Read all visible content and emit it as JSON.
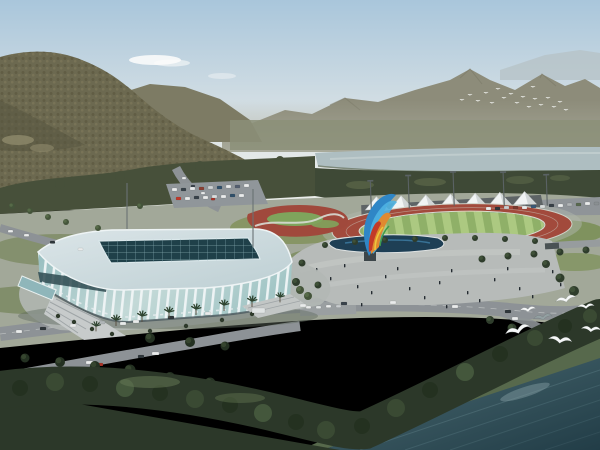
{
  "palette": {
    "skyTop": "#a9c6db",
    "skyHorizon": "#e9ebe8",
    "farRidge": "#b6c1c6",
    "farMountain": "#8d8c7a",
    "midRidge": "#7d7b64",
    "mountain": "#6c6950",
    "mountainShadow": "#585540",
    "forestBand": "#47503a",
    "forestBand2": "#3e4936",
    "river": "#aebec1",
    "parkGround": "#a2a899",
    "road": "#8d9296",
    "plaza": "#b7bbb9",
    "parking": "#90969a",
    "trackRed": "#a24a3c",
    "field1": "#8fb068",
    "field2": "#acc981",
    "tentWhite": "#f1f4f4",
    "grandstand": "#5e6466",
    "poolBlue": "#1e3f55",
    "waterTop": "#4a6a72",
    "waterDeep": "#223d47",
    "shoreGrass": "#57694c",
    "treeDark": "#2c3829",
    "treeMid": "#44543a",
    "arenaRoof": "#cfdce0",
    "arenaSkylight": "#1f4049",
    "arenaGlass": "#9dc2c2",
    "arenaRib": "#f0f5f6",
    "gull": "#f5f7f7"
  },
  "scene": {
    "title": "Aerial rendering of riverside sports complex",
    "landmarks": [
      "forested mountain",
      "distant ridge",
      "river",
      "lattice-facade indoor arena",
      "outdoor athletics track",
      "canopy grandstand",
      "ribbon sculpture",
      "plaza with reflecting pool",
      "lakeshore forest",
      "seagulls"
    ],
    "tents": {
      "x0": 366,
      "step": 24.7,
      "count": 7,
      "baseY": 207,
      "w": 23,
      "h": 13
    },
    "stand_band": {
      "x0": 372,
      "y": 209.5,
      "segW": 19.5,
      "segH": 8,
      "colors": [
        "#a64a42",
        "#4f9a52",
        "#3f64b0",
        "#7b4fa0",
        "#cf8a3c",
        "#c9bf4a",
        "#4286b2",
        "#52974e"
      ]
    },
    "track_poles": [
      [
        372,
        178,
        32
      ],
      [
        410,
        174,
        33
      ],
      [
        455,
        172,
        34
      ],
      [
        505,
        174,
        34
      ],
      [
        548,
        178,
        31
      ]
    ],
    "masts": [
      [
        127,
        183,
        46
      ],
      [
        253,
        189,
        58
      ]
    ],
    "cars": [
      [
        16,
        330,
        "#e9ebeb"
      ],
      [
        40,
        327,
        "#2f373b"
      ],
      [
        70,
        324,
        "#e9ebeb"
      ],
      [
        99,
        321,
        "#b0b6b8"
      ],
      [
        120,
        322,
        "#e9ebeb"
      ],
      [
        133,
        320,
        "#e9ebeb"
      ],
      [
        168,
        316,
        "#2f373b"
      ],
      [
        205,
        312,
        "#e9ebeb"
      ],
      [
        252,
        308,
        "#dfe3e3",
        13,
        5
      ],
      [
        300,
        304,
        "#e9ebeb"
      ],
      [
        341,
        302,
        "#3a434b"
      ],
      [
        390,
        301,
        "#e9ebeb"
      ],
      [
        452,
        305,
        "#e9ebeb"
      ],
      [
        505,
        310,
        "#2f373b"
      ],
      [
        8,
        375,
        "#e9ebeb"
      ],
      [
        28,
        371,
        "#e9ebeb"
      ],
      [
        50,
        367,
        "#c23a2c"
      ],
      [
        86,
        361,
        "#e9ebeb",
        7,
        3
      ],
      [
        97,
        363,
        "#a83428"
      ],
      [
        138,
        355,
        "#2f373b"
      ],
      [
        152,
        352,
        "#e9ebeb",
        7,
        3
      ],
      [
        8,
        230,
        "#e9ebeb",
        5,
        2.5
      ],
      [
        24,
        234,
        "#e9ebeb",
        5,
        2.5
      ],
      [
        50,
        241,
        "#2f373b",
        5,
        2.5
      ],
      [
        78,
        248,
        "#e9ebeb",
        5,
        2.5
      ],
      [
        182,
        177,
        "#e9ebeb",
        4,
        2.2
      ],
      [
        191,
        185,
        "#3a434b",
        4,
        2.2
      ],
      [
        201,
        192,
        "#e9ebeb",
        4,
        2.2
      ],
      [
        211,
        198,
        "#a83428",
        4,
        2.2
      ],
      [
        172,
        188,
        "#e9ebeb",
        5,
        3
      ],
      [
        181,
        188,
        "#39424a",
        5,
        3
      ],
      [
        190,
        187,
        "#e9ebeb",
        5,
        3
      ],
      [
        199,
        187,
        "#8a4034",
        5,
        3
      ],
      [
        208,
        186,
        "#cfd3d4",
        5,
        3
      ],
      [
        217,
        186,
        "#30506a",
        5,
        3
      ],
      [
        226,
        185,
        "#e9ebeb",
        5,
        3
      ],
      [
        235,
        185,
        "#556070",
        5,
        3
      ],
      [
        244,
        184,
        "#e9ebeb",
        5,
        3
      ],
      [
        176,
        197,
        "#c03a2c",
        5,
        3
      ],
      [
        185,
        197,
        "#e9ebeb",
        5,
        3
      ],
      [
        194,
        196,
        "#39424a",
        5,
        3
      ],
      [
        203,
        196,
        "#e9ebeb",
        5,
        3
      ],
      [
        212,
        195,
        "#d8dcdc",
        5,
        3
      ],
      [
        221,
        195,
        "#e9ebeb",
        5,
        3
      ],
      [
        230,
        194,
        "#30506a",
        5,
        3
      ],
      [
        239,
        194,
        "#e9ebeb",
        5,
        3
      ],
      [
        486,
        207,
        "#e9ebeb",
        5,
        3
      ],
      [
        495,
        207,
        "#2f373b",
        5,
        3
      ],
      [
        504,
        206,
        "#c8ccce",
        5,
        3
      ],
      [
        513,
        206,
        "#7a3a30",
        5,
        3
      ],
      [
        522,
        206,
        "#e9ebeb",
        5,
        3
      ],
      [
        531,
        205,
        "#3a5a78",
        5,
        3
      ],
      [
        540,
        205,
        "#d8dcdc",
        5,
        3
      ],
      [
        549,
        204,
        "#384048",
        5,
        3
      ],
      [
        558,
        204,
        "#e9ebeb",
        5,
        3
      ],
      [
        567,
        203,
        "#b0b4b6",
        5,
        3
      ],
      [
        576,
        203,
        "#5a6a50",
        5,
        3
      ],
      [
        585,
        202,
        "#e9ebeb",
        5,
        3
      ],
      [
        594,
        202,
        "#8a8f92",
        5,
        3
      ],
      [
        306,
        306,
        "#e9ebeb",
        5,
        2.6
      ],
      [
        316,
        306,
        "#dfe3e3",
        5,
        2.6
      ],
      [
        326,
        305,
        "#e9ebeb",
        5,
        2.6
      ],
      [
        336,
        305,
        "#c8ccce",
        5,
        2.6
      ],
      [
        512,
        317,
        "#e9ebeb"
      ],
      [
        538,
        329,
        "#2f373b"
      ]
    ],
    "people": [
      [
        316,
        268
      ],
      [
        330,
        277
      ],
      [
        344,
        264
      ],
      [
        357,
        285
      ],
      [
        371,
        291
      ],
      [
        385,
        275
      ],
      [
        397,
        267
      ],
      [
        409,
        287
      ],
      [
        424,
        296
      ],
      [
        439,
        281
      ],
      [
        451,
        269
      ],
      [
        467,
        291
      ],
      [
        479,
        299
      ],
      [
        494,
        278
      ],
      [
        507,
        267
      ],
      [
        519,
        287
      ],
      [
        532,
        295
      ],
      [
        309,
        294
      ],
      [
        361,
        303
      ],
      [
        446,
        305
      ],
      [
        262,
        306
      ],
      [
        275,
        310
      ],
      [
        287,
        302
      ],
      [
        552,
        270
      ],
      [
        560,
        283
      ]
    ],
    "palms": [
      [
        116,
        320,
        1
      ],
      [
        142,
        316,
        1
      ],
      [
        169,
        312,
        1
      ],
      [
        196,
        309,
        1
      ],
      [
        224,
        305,
        1
      ],
      [
        252,
        301,
        1
      ],
      [
        280,
        297,
        0.9
      ],
      [
        96,
        326,
        0.9
      ]
    ],
    "trees": [
      [
        325,
        245,
        3,
        0
      ],
      [
        355,
        242,
        3,
        0
      ],
      [
        385,
        240,
        3,
        0
      ],
      [
        415,
        239,
        3,
        0
      ],
      [
        445,
        238,
        3,
        0
      ],
      [
        475,
        238,
        3,
        0
      ],
      [
        505,
        239,
        3,
        0
      ],
      [
        535,
        241,
        3,
        0
      ],
      [
        482,
        259,
        3.5,
        0
      ],
      [
        508,
        256,
        3.5,
        0
      ],
      [
        534,
        254,
        3.5,
        0
      ],
      [
        560,
        252,
        3.5,
        0
      ],
      [
        586,
        250,
        3.5,
        0
      ],
      [
        546,
        264,
        4,
        0
      ],
      [
        560,
        278,
        4.5,
        0
      ],
      [
        574,
        291,
        5,
        0
      ],
      [
        302,
        263,
        3.5,
        0
      ],
      [
        296,
        282,
        4,
        0
      ],
      [
        308,
        296,
        4,
        1
      ],
      [
        300,
        290,
        4,
        1
      ],
      [
        318,
        285,
        3.5,
        0
      ],
      [
        12,
        206,
        3,
        1
      ],
      [
        30,
        211,
        3,
        1
      ],
      [
        48,
        217,
        3,
        1
      ],
      [
        66,
        222,
        3,
        1
      ],
      [
        98,
        228,
        3,
        1
      ],
      [
        140,
        206,
        3,
        1
      ],
      [
        25,
        358,
        4.5,
        2
      ],
      [
        60,
        362,
        5,
        2
      ],
      [
        95,
        366,
        5,
        2
      ],
      [
        130,
        370,
        5.5,
        2
      ],
      [
        170,
        377,
        5,
        2
      ],
      [
        210,
        383,
        5.5,
        2
      ],
      [
        150,
        338,
        5,
        2
      ],
      [
        190,
        342,
        5,
        2
      ],
      [
        225,
        346,
        4.5,
        2
      ],
      [
        490,
        320,
        4,
        0
      ],
      [
        512,
        328,
        4.5,
        0
      ]
    ],
    "flock_birds": [
      [
        462,
        100
      ],
      [
        470,
        95
      ],
      [
        478,
        101
      ],
      [
        486,
        93
      ],
      [
        492,
        103
      ],
      [
        498,
        89
      ],
      [
        504,
        98
      ],
      [
        511,
        94
      ],
      [
        517,
        103
      ],
      [
        523,
        97
      ],
      [
        529,
        107
      ],
      [
        535,
        99
      ],
      [
        541,
        105
      ],
      [
        548,
        98
      ],
      [
        554,
        107
      ],
      [
        560,
        102
      ],
      [
        566,
        110
      ],
      [
        533,
        87
      ]
    ],
    "seagulls": [
      [
        518,
        331,
        1.3,
        -14,
        "w"
      ],
      [
        543,
        318,
        0.95,
        -6,
        "g"
      ],
      [
        566,
        300,
        1.05,
        -10,
        "w"
      ],
      [
        586,
        307,
        0.85,
        -2,
        "w"
      ],
      [
        591,
        330,
        1.0,
        8,
        "w"
      ],
      [
        560,
        341,
        1.2,
        10,
        "w"
      ],
      [
        528,
        310,
        0.8,
        -4,
        "w"
      ]
    ]
  }
}
